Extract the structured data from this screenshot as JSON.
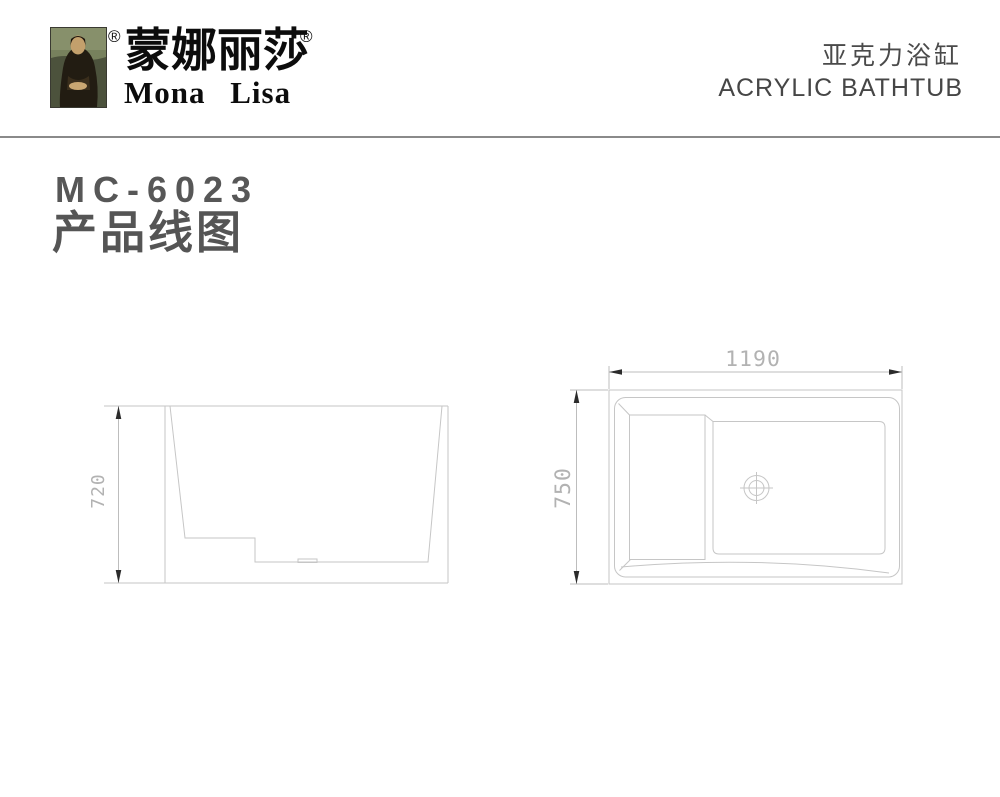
{
  "header": {
    "reg_mark": "®",
    "brand_zh": "蒙娜丽莎",
    "brand_en": "Mona  Lisa",
    "product_zh": "亚克力浴缸",
    "product_en": "ACRYLIC BATHTUB"
  },
  "title": {
    "model": "MC-6023",
    "subtitle_zh": "产品线图"
  },
  "drawings": {
    "side_view": {
      "name": "bathtub-side-elevation",
      "height_label": "720"
    },
    "top_view": {
      "name": "bathtub-plan-view",
      "width_label": "1190",
      "depth_label": "750"
    }
  },
  "colors": {
    "drawing_line": "#c6c6c6",
    "dimension_line": "#bdbdbd",
    "dimension_text": "#b2b2b2",
    "arrowhead": "#2b2b2b",
    "title_text": "#575757",
    "header_text": "#4a4a4a",
    "brand_text": "#0c0c0c",
    "divider": "#8a8a8a",
    "background": "#ffffff"
  }
}
